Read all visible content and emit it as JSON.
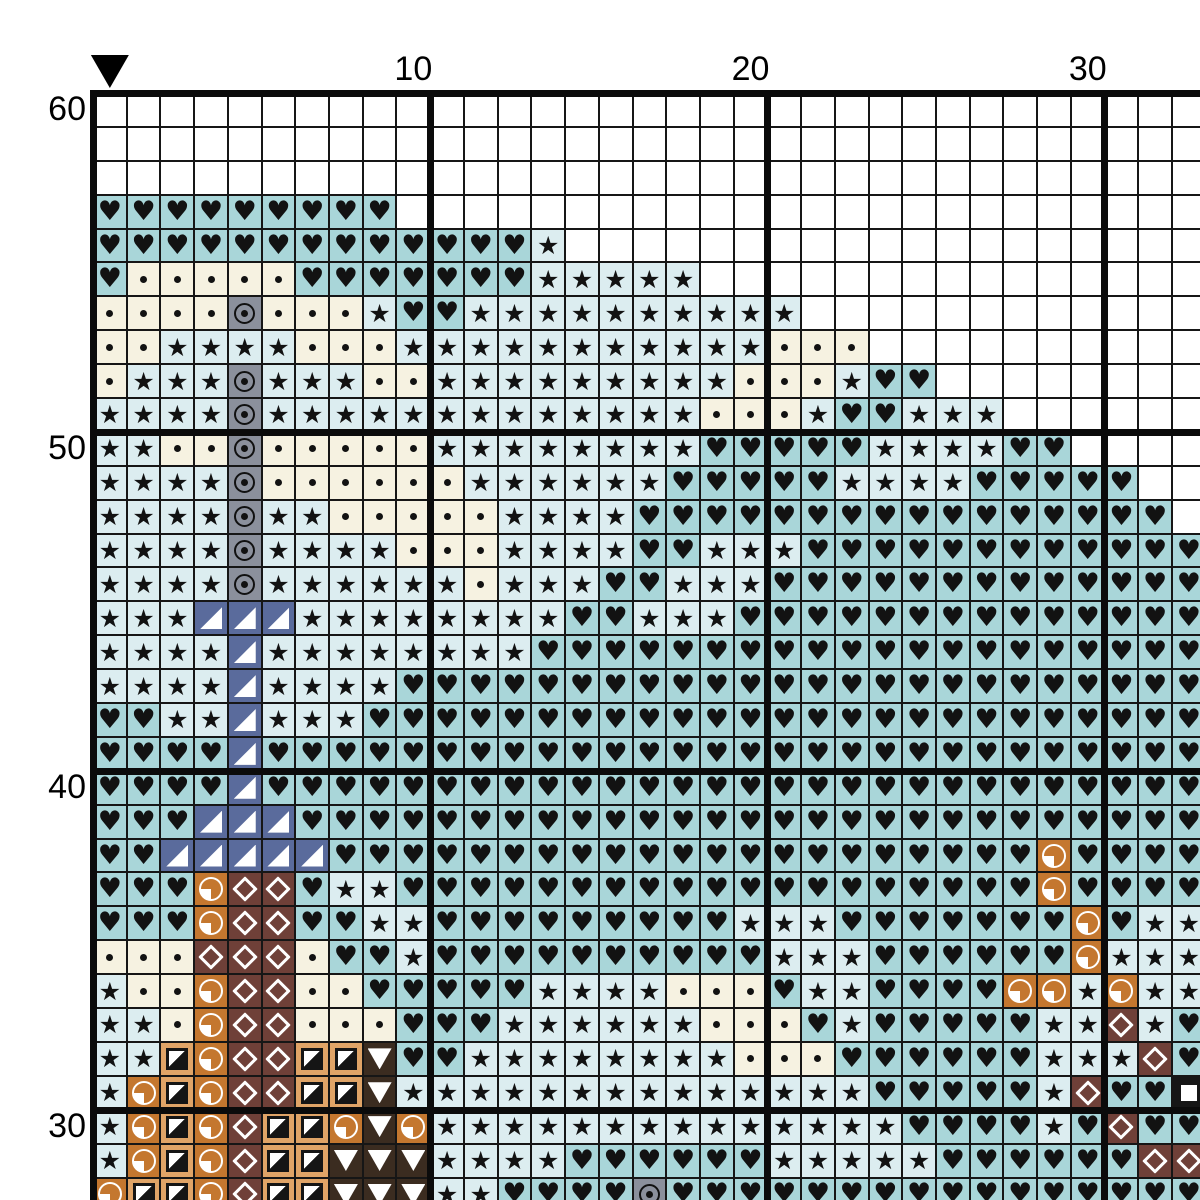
{
  "pattern_chart": {
    "kind": "cross-stitch-grid",
    "axis": {
      "top_labels": [
        {
          "text": "10",
          "col": 10
        },
        {
          "text": "20",
          "col": 20
        },
        {
          "text": "30",
          "col": 30
        }
      ],
      "left_labels": [
        {
          "text": "60",
          "row": 60
        },
        {
          "text": "50",
          "row": 50
        },
        {
          "text": "40",
          "row": 40
        },
        {
          "text": "30",
          "row": 30
        }
      ],
      "center_marker_col": 1
    },
    "colors": {
      "grid_line": "#161616",
      "thick_line": "#0b0b0b",
      "symbol_ink": "#121212",
      "marker": "#000000"
    },
    "legend": {
      ".": {
        "name": "empty",
        "bg": "#ffffff",
        "glyph": ""
      },
      "h": {
        "name": "heart",
        "bg": "#a9d6d9",
        "glyph": "♥"
      },
      "s": {
        "name": "star",
        "bg": "#dcedf0",
        "glyph": "★"
      },
      "d": {
        "name": "dot",
        "bg": "#f6f2e1",
        "glyph": ""
      },
      "o": {
        "name": "circled-dot",
        "bg": "#8b909c",
        "glyph": ""
      },
      "n": {
        "name": "triangle-corner",
        "bg": "#5a6b9c",
        "glyph": ""
      },
      "q": {
        "name": "quarter-circle",
        "bg": "#c4772f",
        "glyph": ""
      },
      "t": {
        "name": "half-square",
        "bg": "#e0a467",
        "glyph": ""
      },
      "m": {
        "name": "diamond",
        "bg": "#6f4038",
        "glyph": ""
      },
      "v": {
        "name": "triangle-down",
        "bg": "#3b2c20",
        "glyph": ""
      },
      "b": {
        "name": "square",
        "bg": "#161616",
        "glyph": ""
      }
    },
    "grid": {
      "cols": 33,
      "first_row_number": 60,
      "last_row_number": 28,
      "rows": [
        {
          "n": 60,
          "cells": "................................."
        },
        {
          "n": 59,
          "cells": "................................."
        },
        {
          "n": 58,
          "cells": "................................."
        },
        {
          "n": 57,
          "cells": "hhhhhhhhh........................"
        },
        {
          "n": 56,
          "cells": "hhhhhhhhhhhhhs..................."
        },
        {
          "n": 55,
          "cells": "hdddddhhhhhhhsssss..............."
        },
        {
          "n": 54,
          "cells": "ddddodddshhssssssssss............"
        },
        {
          "n": 53,
          "cells": "ddssssdddsssssssssssddd.........."
        },
        {
          "n": 52,
          "cells": "dsssosssddsssssssssdddshh........"
        },
        {
          "n": 51,
          "cells": "ssssosssssssssssssdddshhsss......"
        },
        {
          "n": 50,
          "cells": "ssddodddddsssssssshhhhhsssshh...."
        },
        {
          "n": 49,
          "cells": "ssssoddddddsssssshhhhhsssshhhhh.."
        },
        {
          "n": 48,
          "cells": "ssssossdddddsssshhhhhhhhhhhhhhhh."
        },
        {
          "n": 47,
          "cells": "ssssossssdddsssshhssshhhhhhhhhhhh"
        },
        {
          "n": 46,
          "cells": "ssssossssssdssshhssshhhhhhhhhhhhh"
        },
        {
          "n": 45,
          "cells": "sssnnnsssssssshhssshhhhhhhhhhhhhh"
        },
        {
          "n": 44,
          "cells": "ssssnsssssssshhhhhhhhhhhhhhhhhhhh"
        },
        {
          "n": 43,
          "cells": "ssssnsssshhhhhhhhhhhhhhhhhhhhhhhh"
        },
        {
          "n": 42,
          "cells": "hhssnssshhhhhhhhhhhhhhhhhhhhhhhhh"
        },
        {
          "n": 41,
          "cells": "hhhhnhhhhhhhhhhhhhhhhhhhhhhhhhhhh"
        },
        {
          "n": 40,
          "cells": "hhhhnhhhhhhhhhhhhhhhhhhhhhhhhhhhh"
        },
        {
          "n": 39,
          "cells": "hhhnnnhhhhhhhhhhhhhhhhhhhhhhhhhhh"
        },
        {
          "n": 38,
          "cells": "hhnnnnnhhhhhhhhhhhhhhhhhhhhhqhhhh"
        },
        {
          "n": 37,
          "cells": "hhhqmmhsshhhhhhhhhhhhhhhhhhhqhhhh"
        },
        {
          "n": 36,
          "cells": "hhhqmmhhsshhhhhhhhhssshhhhhhhqhss"
        },
        {
          "n": 35,
          "cells": "dddmmmdhhshhhhhhhhhhssshhhhhhqsss"
        },
        {
          "n": 34,
          "cells": "sddqmmddhhhhhssssdddhsshhhhqqsqss"
        },
        {
          "n": 33,
          "cells": "ssdqmmdddhhhssssssdddhshhhhhssmsh"
        },
        {
          "n": 32,
          "cells": "sstqmmttvhhssssssssdddhhhhhhsssmh"
        },
        {
          "n": 31,
          "cells": "sqtqmmttvsssssssssssssshhhhhsmhhb"
        },
        {
          "n": 30,
          "cells": "sqtqmttqvqsssssssssssssshhhhshmhh"
        },
        {
          "n": 29,
          "cells": "sqtqmttvvvsssshhhhhhssssshhhhhhmm"
        },
        {
          "n": 28,
          "cells": "qttqmttvvvsshhhhohhhhhhhhhhhhhhhh"
        }
      ]
    }
  }
}
